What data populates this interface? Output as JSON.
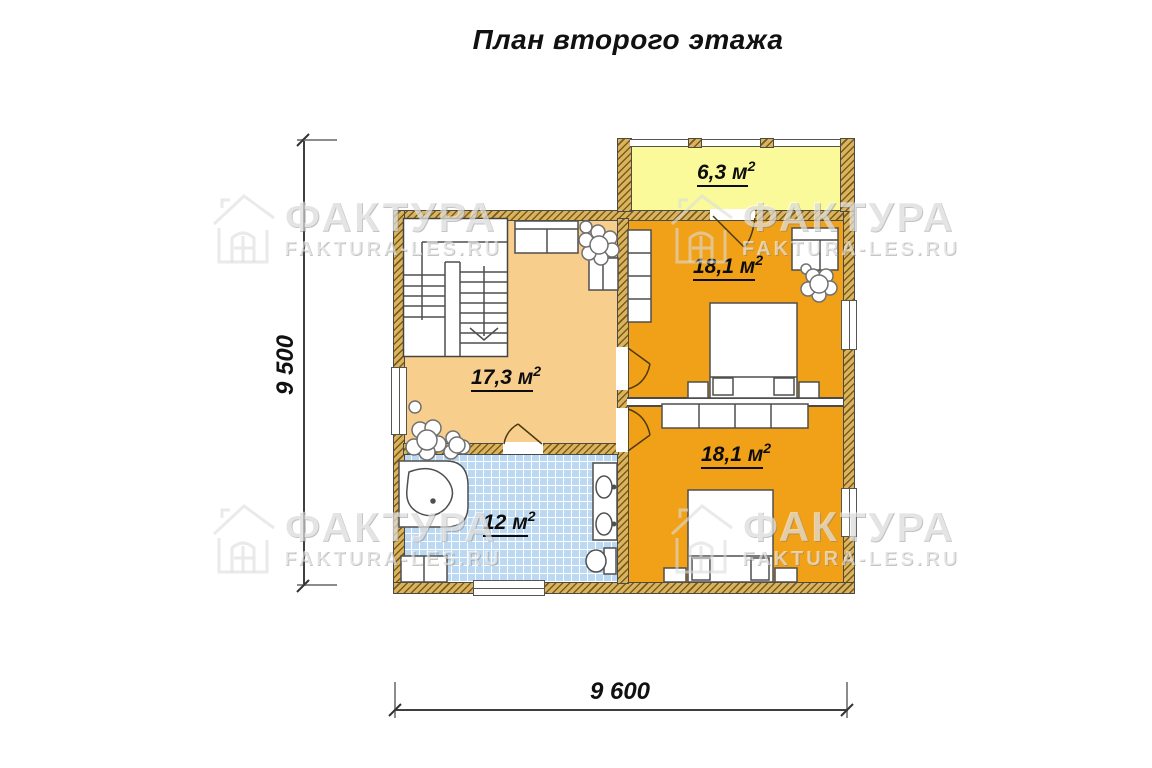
{
  "title": "План второго этажа",
  "watermark": {
    "brand": "ФАКТУРА",
    "site": "FAKTURA-LES.RU"
  },
  "rooms": [
    {
      "name": "balcony",
      "area": "6,3 м",
      "sup": "2"
    },
    {
      "name": "bedroom-top",
      "area": "18,1 м",
      "sup": "2"
    },
    {
      "name": "hall",
      "area": "17,3 м",
      "sup": "2"
    },
    {
      "name": "bedroom-bottom",
      "area": "18,1 м",
      "sup": "2"
    },
    {
      "name": "bathroom",
      "area": "12 м",
      "sup": "2"
    }
  ],
  "dimensions": {
    "height": "9 500",
    "width": "9 600"
  },
  "colors": {
    "wall": "#D9B45C",
    "wall_hatch": "#7a5a1e",
    "balcony": "#FAFA9B",
    "bedroom": "#F1A117",
    "hall": "#F8CE8C",
    "bathroom": "#BBD9F2",
    "furniture_outline": "#4f4f4f"
  }
}
